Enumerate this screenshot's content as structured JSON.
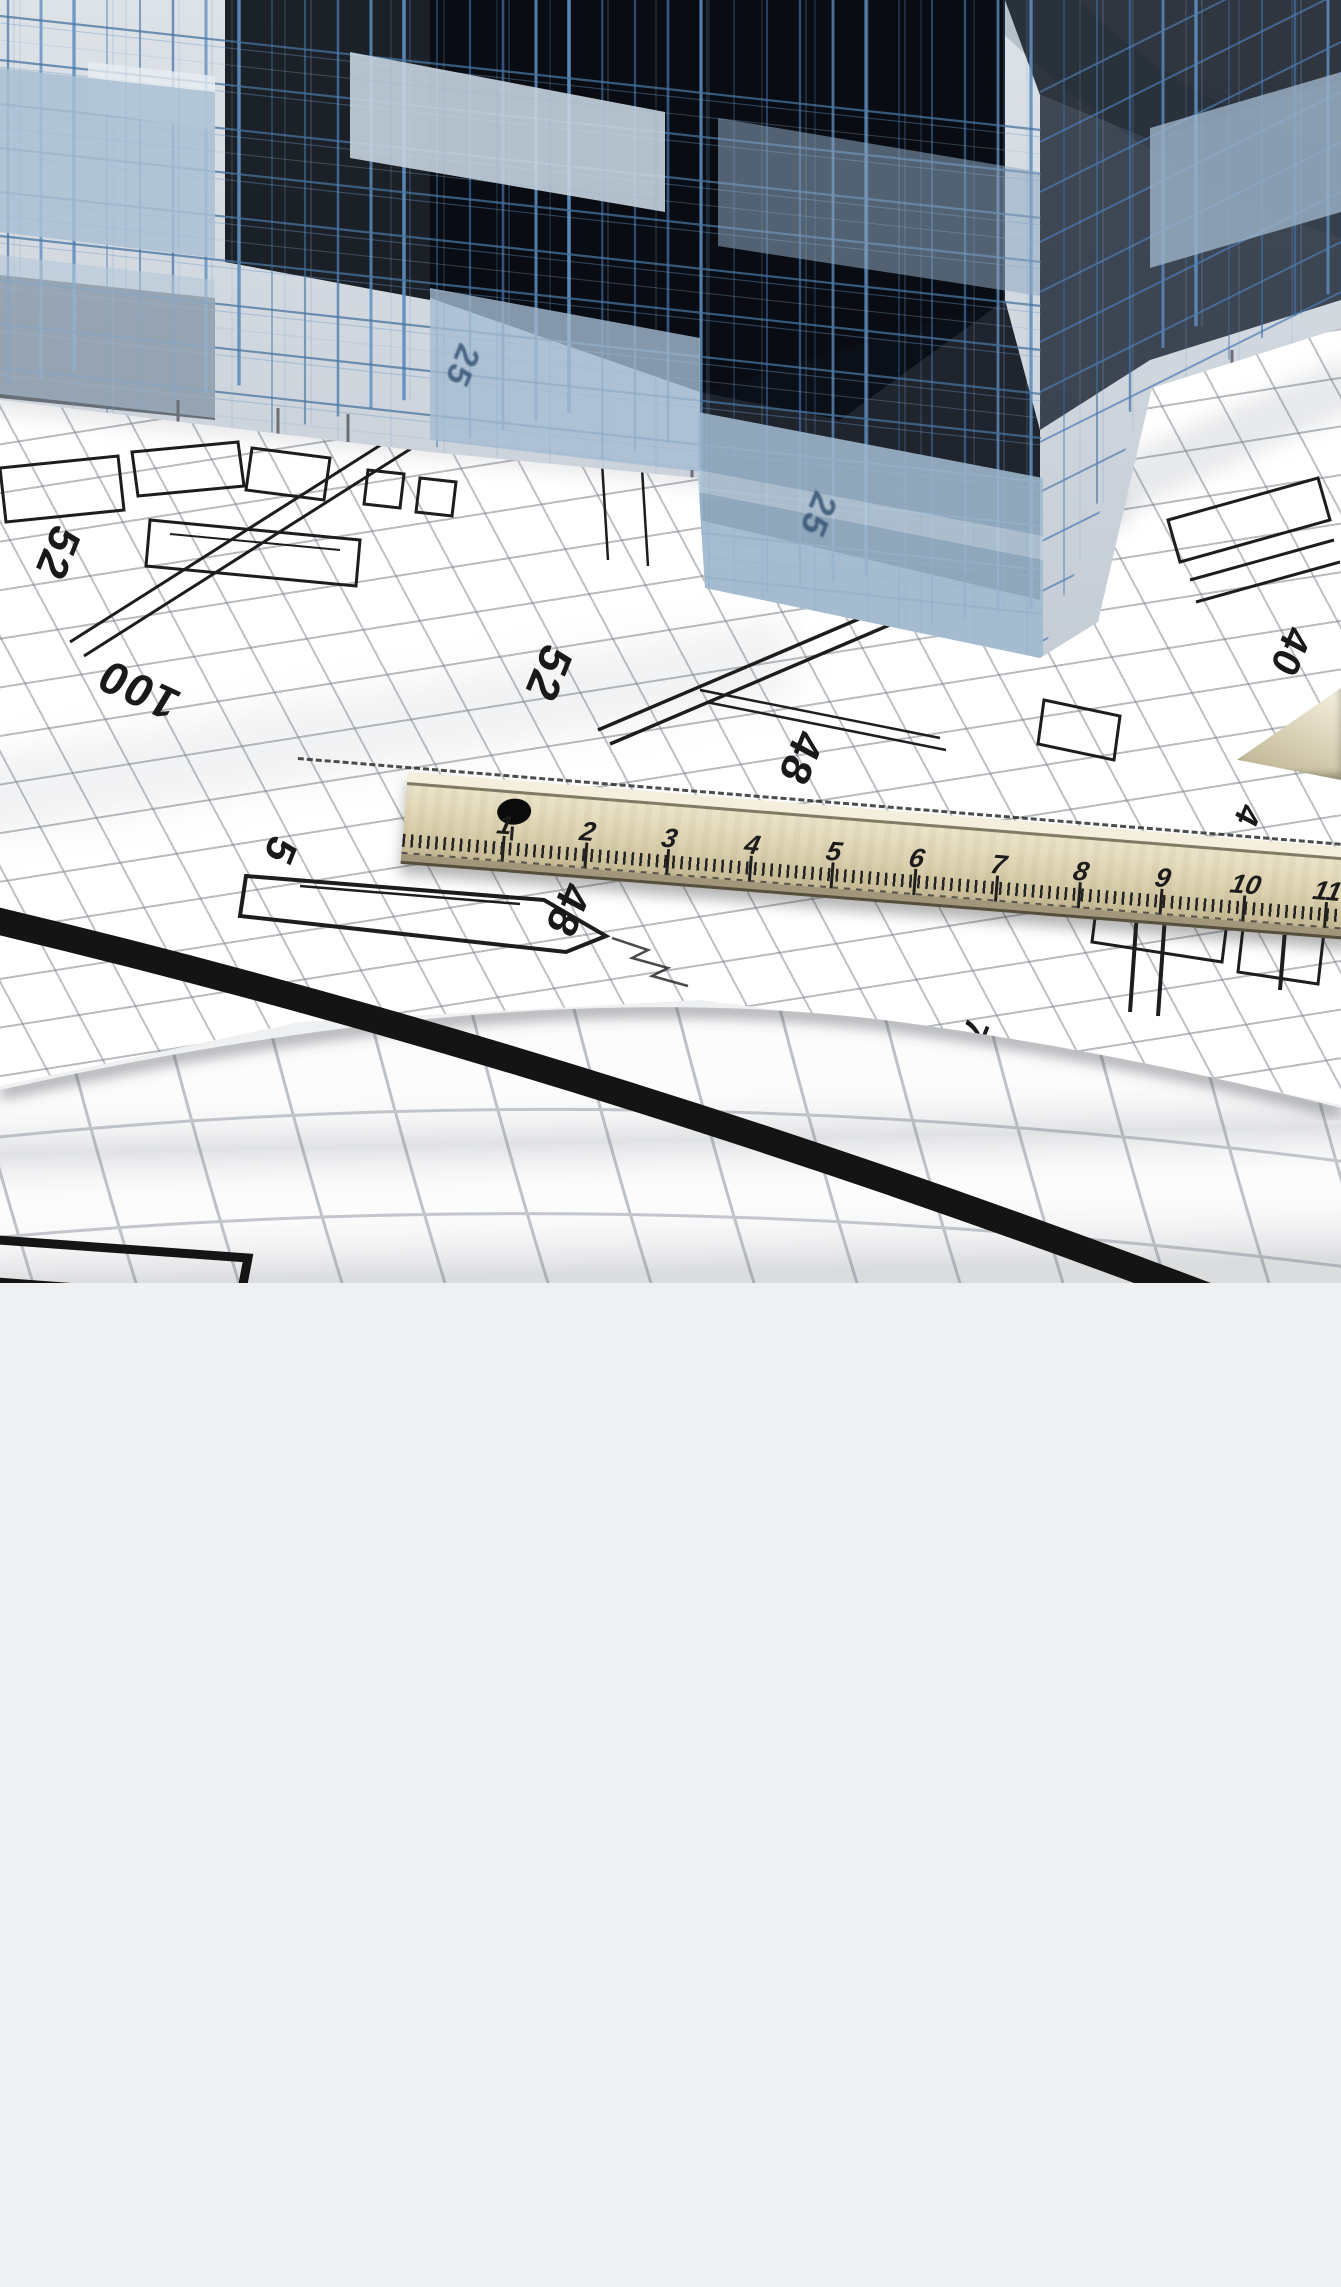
{
  "blueprint": {
    "annotations": [
      {
        "text": "52",
        "x": 57,
        "y": 553,
        "rot": 112,
        "kind": "ink",
        "size": 44
      },
      {
        "text": "100",
        "x": 138,
        "y": 690,
        "rot": 205,
        "kind": "ink",
        "size": 46
      },
      {
        "text": "52",
        "x": 549,
        "y": 674,
        "rot": 112,
        "kind": "ink",
        "size": 46
      },
      {
        "text": "48",
        "x": 800,
        "y": 758,
        "rot": 112,
        "kind": "ink",
        "size": 44
      },
      {
        "text": "40",
        "x": 1290,
        "y": 652,
        "rot": 112,
        "kind": "ink",
        "size": 40
      },
      {
        "text": "5",
        "x": 280,
        "y": 851,
        "rot": 112,
        "kind": "ink",
        "size": 42
      },
      {
        "text": "48",
        "x": 567,
        "y": 910,
        "rot": 112,
        "kind": "ink",
        "size": 44
      },
      {
        "text": "7",
        "x": 975,
        "y": 1030,
        "rot": 112,
        "kind": "ink",
        "size": 34
      },
      {
        "text": "4",
        "x": 1247,
        "y": 816,
        "rot": 112,
        "kind": "ink",
        "size": 34
      },
      {
        "text": "25",
        "x": 462,
        "y": 366,
        "rot": 112,
        "kind": "glass",
        "size": 34
      },
      {
        "text": "25",
        "x": 818,
        "y": 515,
        "rot": 112,
        "kind": "glass",
        "size": 36
      }
    ]
  },
  "ruler": {
    "marks": [
      "1",
      "2",
      "3",
      "4",
      "5",
      "6",
      "7",
      "8",
      "9",
      "10",
      "11"
    ]
  },
  "palette": {
    "sky_gray": "#ccd4dc",
    "dark_void": "#0a0e14",
    "wireframe_blue": "#4d7db6",
    "wireframe_light": "#7fa6cf",
    "glass_blue": "#a9bfd4",
    "glass_bright": "#c6d4e0",
    "paper_white": "#ffffff",
    "grid_gray": "#9fa6ad",
    "plan_ink": "#1d1d1d",
    "ruler_wood": "#e6ddbf",
    "ruler_edge": "#564f3e",
    "stripe_black": "#141414",
    "roll_grid": "#b5bac1"
  }
}
